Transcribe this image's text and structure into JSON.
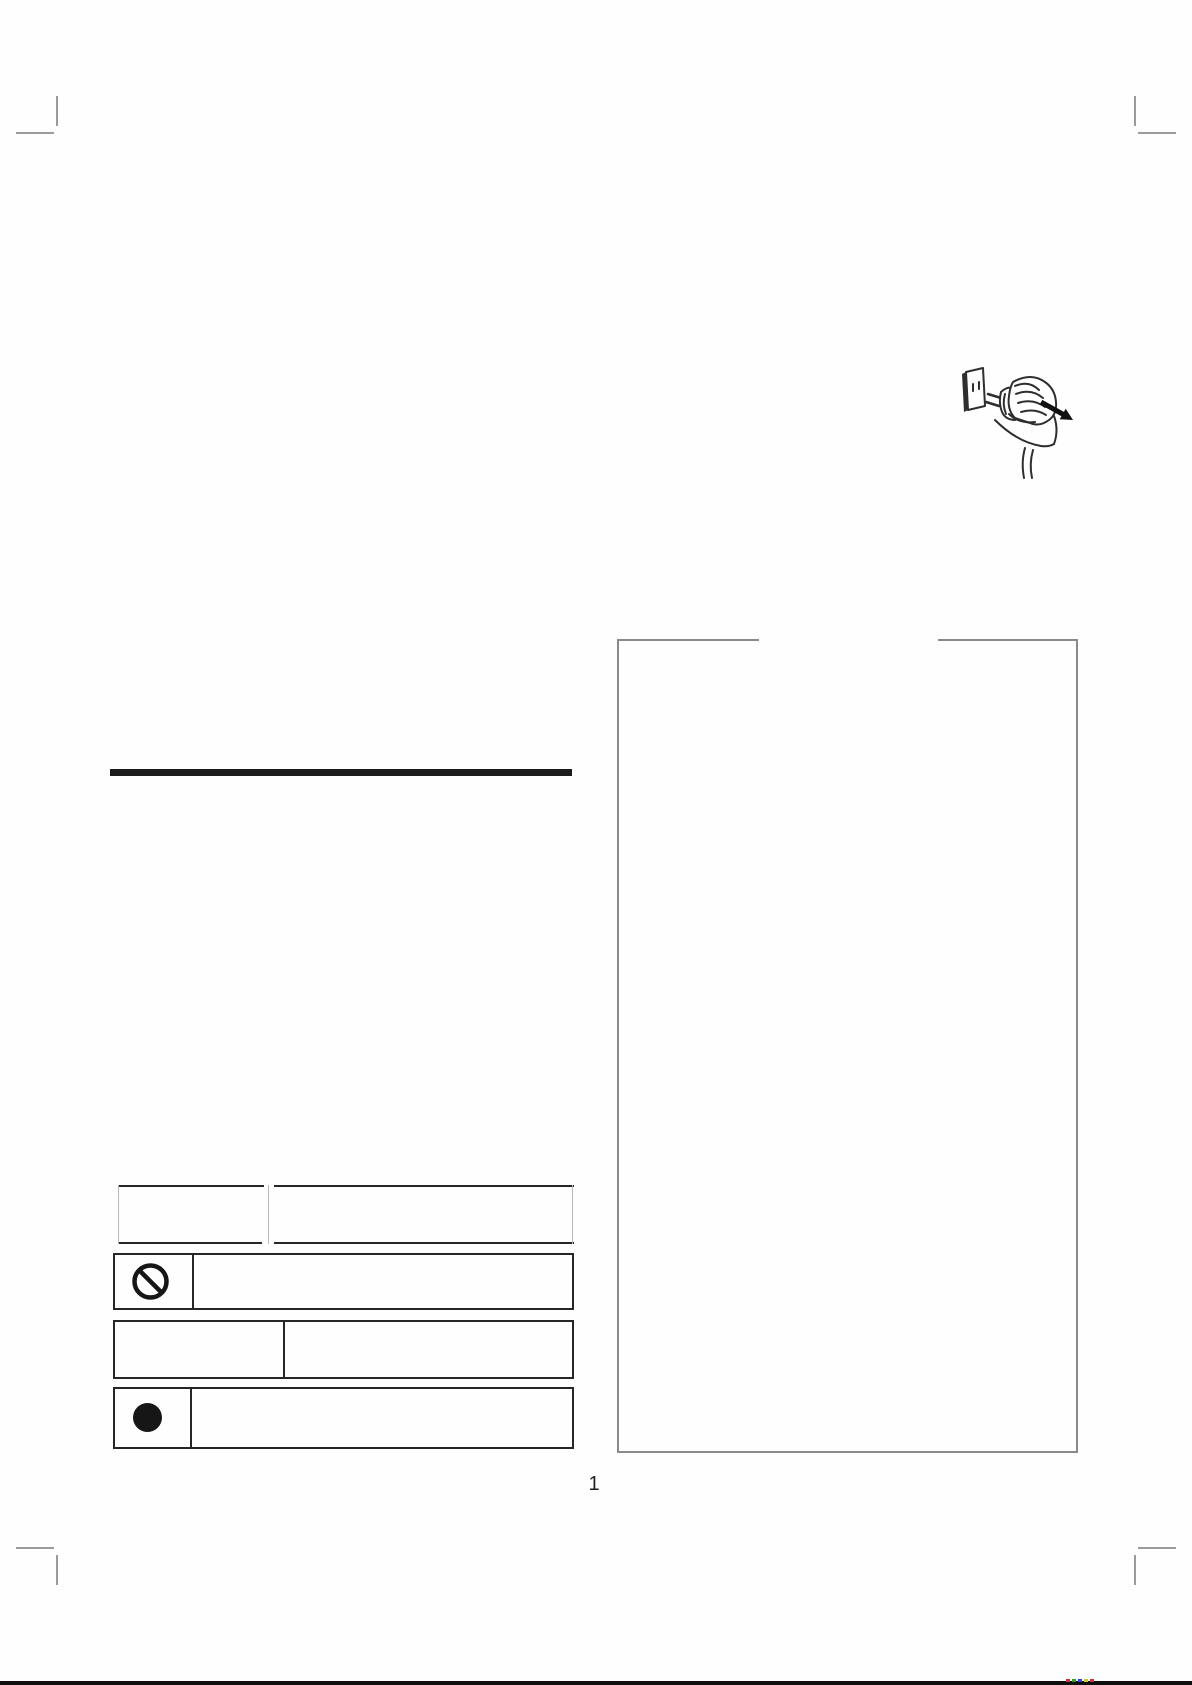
{
  "page": {
    "number": "1"
  },
  "icons": {
    "prohibition": "prohibition-icon",
    "mandatory": "mandatory-filled-circle-icon",
    "illustration": "hand-unplugging-power-plug-from-outlet"
  },
  "colors": {
    "ink": "#262626",
    "frame": "#8a8a8a",
    "rule": "#1c1c1c"
  },
  "registration_marks": [
    "#cf3333",
    "#2f9e2f",
    "#3344cc",
    "#c9c932",
    "#cf3333"
  ]
}
